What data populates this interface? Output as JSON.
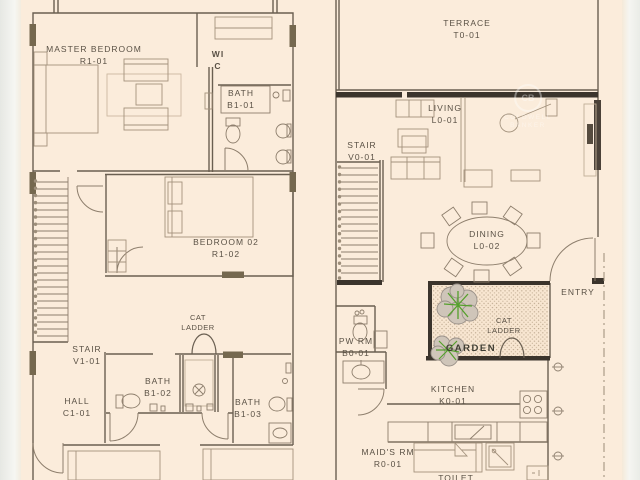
{
  "drawing": {
    "kind": "residential floor plans, two levels side by side"
  },
  "colors": {
    "paper": "#fbecdb",
    "edge_strip": "#e9ebe6",
    "wall": "#6a5f51",
    "wall_thick": "#3b342c",
    "wall_marker": "#75684f",
    "furniture": "#a3927d",
    "fixture": "#8d7e6c",
    "text": "#5a5145",
    "stipple_dot": "#bca78d",
    "tree_green": "#55a02c",
    "tree_grey": "#9a9189"
  },
  "watermark": {
    "initials": "CB",
    "line1": "COLDWELL",
    "line2": "BANKER"
  },
  "upper_floor": {
    "master_bedroom": {
      "name": "MASTER BEDROOM",
      "code": "R1-01"
    },
    "wic": {
      "line1": "WI",
      "line2": "C"
    },
    "bath1": {
      "name": "BATH",
      "code": "B1-01"
    },
    "bedroom2": {
      "name": "BEDROOM 02",
      "code": "R1-02"
    },
    "cat_ladder": {
      "line1": "CAT",
      "line2": "LADDER"
    },
    "stair": {
      "name": "STAIR",
      "code": "V1-01"
    },
    "hall": {
      "name": "HALL",
      "code": "C1-01"
    },
    "bath2": {
      "name": "BATH",
      "code": "B1-02"
    },
    "bath3": {
      "name": "BATH",
      "code": "B1-03"
    }
  },
  "ground_floor": {
    "terrace": {
      "name": "TERRACE",
      "code": "T0-01"
    },
    "living": {
      "name": "LIVING",
      "code": "L0-01"
    },
    "stair": {
      "name": "STAIR",
      "code": "V0-01"
    },
    "dining": {
      "name": "DINING",
      "code": "L0-02"
    },
    "entry": {
      "name": "ENTRY"
    },
    "garden": {
      "name": "GARDEN"
    },
    "cat_ladder": {
      "line1": "CAT",
      "line2": "LADDER"
    },
    "pw_rm": {
      "name": "PW RM",
      "code": "B0-01"
    },
    "kitchen": {
      "name": "KITCHEN",
      "code": "K0-01"
    },
    "maids_rm": {
      "name": "MAID'S RM",
      "code": "R0-01"
    },
    "toilet": {
      "name": "TOILET"
    }
  }
}
